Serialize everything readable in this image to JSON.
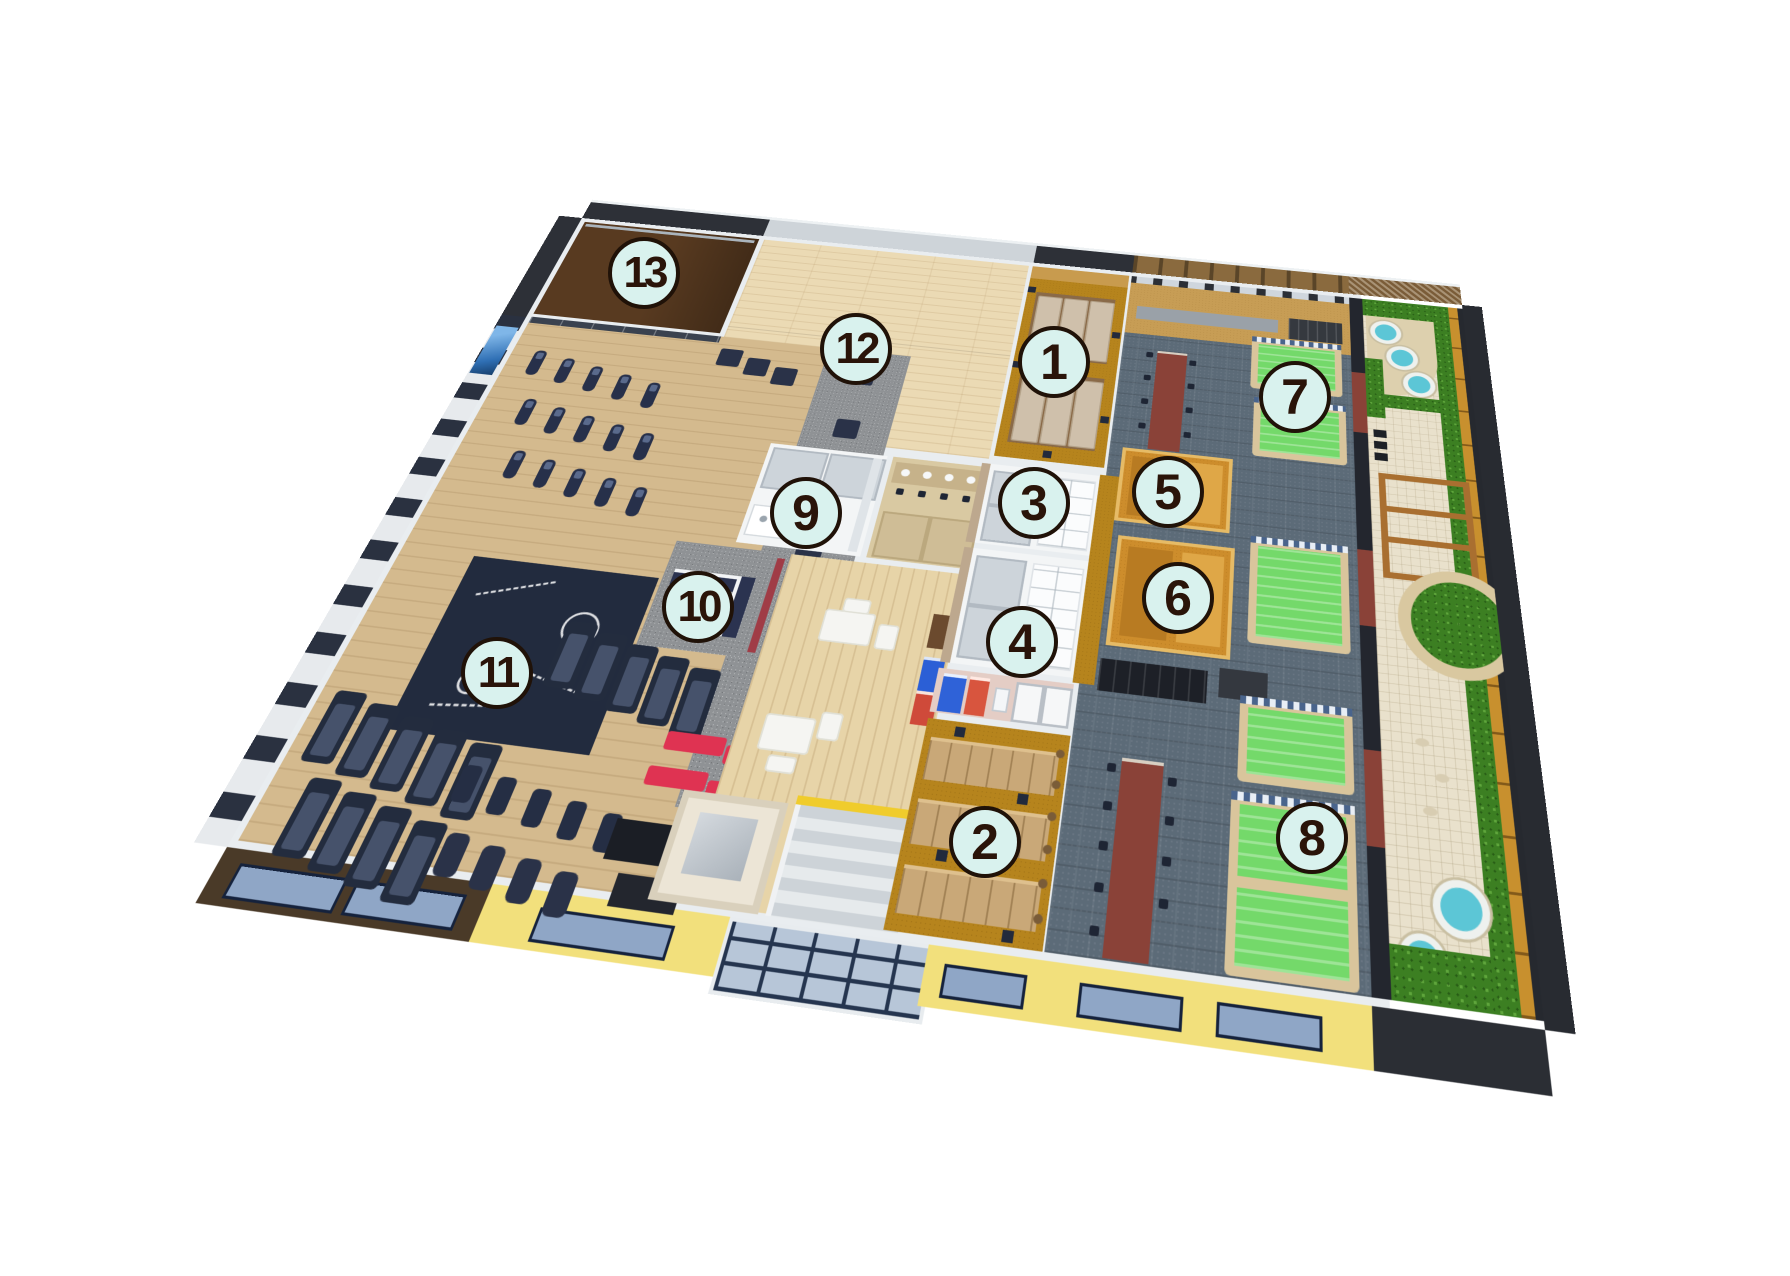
{
  "scene": {
    "type": "isometric-facility-floorplan",
    "background": "#ffffff",
    "marker": {
      "fill": "#d9f2ee",
      "border": "#201208",
      "text": "#2a1409"
    }
  },
  "markers": [
    {
      "label": "1",
      "x": 1054,
      "y": 362
    },
    {
      "label": "2",
      "x": 985,
      "y": 842
    },
    {
      "label": "3",
      "x": 1034,
      "y": 503
    },
    {
      "label": "4",
      "x": 1022,
      "y": 642
    },
    {
      "label": "5",
      "x": 1168,
      "y": 492
    },
    {
      "label": "6",
      "x": 1178,
      "y": 598
    },
    {
      "label": "7",
      "x": 1295,
      "y": 397
    },
    {
      "label": "8",
      "x": 1312,
      "y": 838
    },
    {
      "label": "9",
      "x": 806,
      "y": 513
    },
    {
      "label": "10",
      "x": 698,
      "y": 607
    },
    {
      "label": "11",
      "x": 497,
      "y": 673
    },
    {
      "label": "12",
      "x": 856,
      "y": 349
    },
    {
      "label": "13",
      "x": 644,
      "y": 273
    }
  ],
  "palette": {
    "gym_wood": "#d4ba8e",
    "studio_wood": "#ebdab4",
    "dark_studio_floor": "#583a20",
    "spa_carpet_gold": "#b6841d",
    "bath_tile": "#5c6b78",
    "pool_water_green": "#74d96a",
    "pool_edge_stone": "#d9c59c",
    "pool_border_check_blue": "#49648c",
    "sauna_wood": "#cd8d2c",
    "wash_partition_maroon": "#8a4238",
    "garden_paving": "#e9e1cc",
    "hedge_green": "#3c7f22",
    "hot_tub_water": "#5cc6d6",
    "fence_wood": "#c8902e",
    "exterior_yellow": "#f2e07c",
    "exterior_dark_brown": "#4a3a28",
    "window_glass": "#8fa6c6",
    "equipment_navy": "#232c3e",
    "bench_red": "#df3352",
    "wall_white": "#e9edf0",
    "back_wall_charcoal": "#2d3037"
  }
}
